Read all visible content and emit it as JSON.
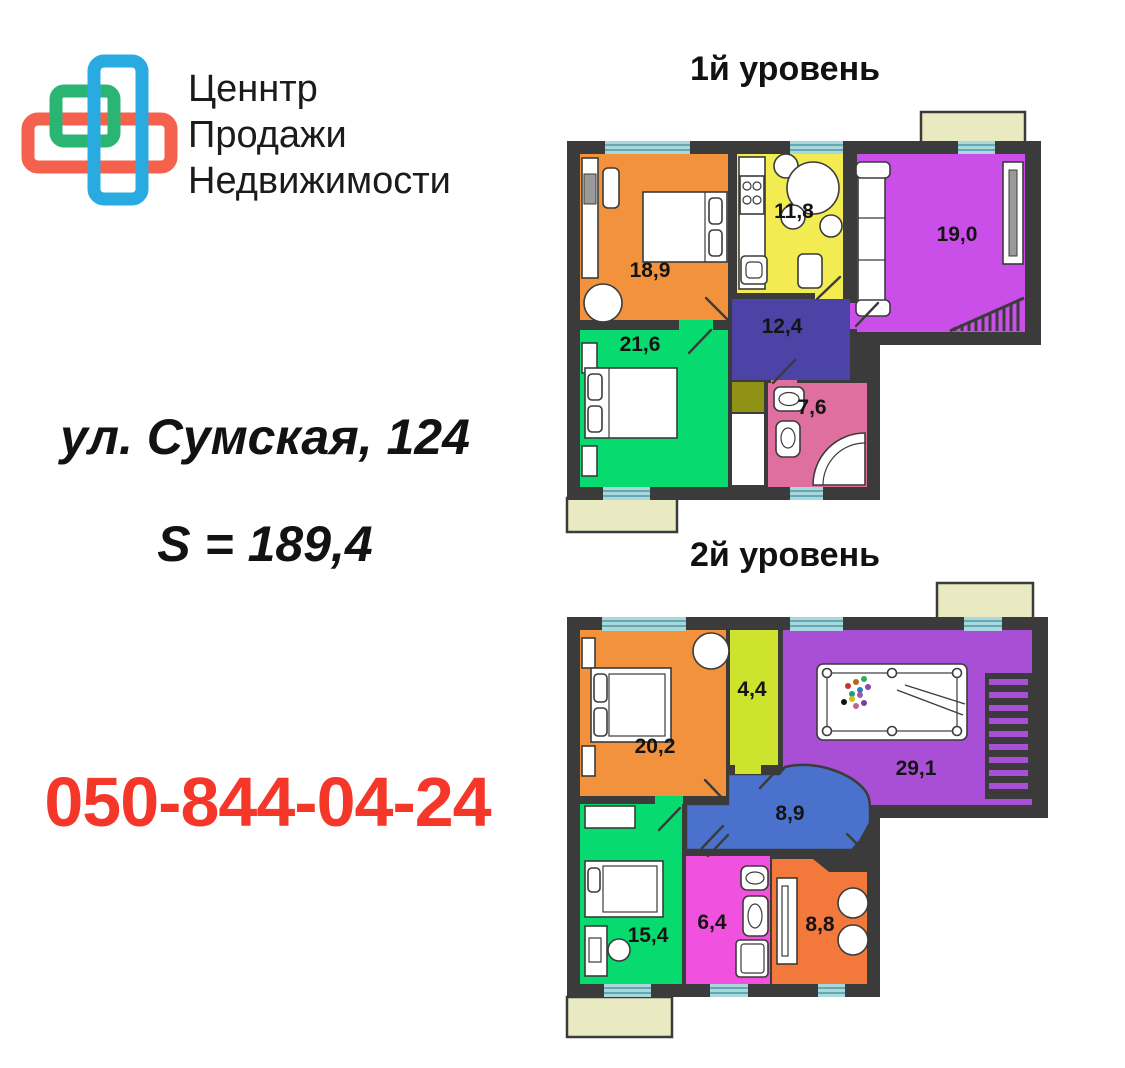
{
  "logo": {
    "line1": "Ценнтр",
    "line2": "Продажи",
    "line3": "Недвижимости",
    "colors": {
      "blue": "#29ABE2",
      "green": "#2BB573",
      "red": "#F4624E"
    }
  },
  "listing": {
    "address": "ул. Сумская, 124",
    "total_area": "S = 189,4",
    "phone": "050-844-04-24",
    "phone_color": "#F5372A"
  },
  "palette": {
    "wall": "#3B3B3B",
    "window_glass": "#A9D7DB",
    "window_line": "#63A9B4",
    "balcony": "#E9EAC1"
  },
  "floor1": {
    "title": "1й уровень",
    "rooms": [
      {
        "id": "bedroom-1",
        "area": "18,9",
        "color": "#F2923C"
      },
      {
        "id": "kitchen",
        "area": "11,8",
        "color": "#F2EC52"
      },
      {
        "id": "living-room",
        "area": "19,0",
        "color": "#C94FE8"
      },
      {
        "id": "bedroom-2",
        "area": "21,6",
        "color": "#07DB70"
      },
      {
        "id": "hallway",
        "area": "12,4",
        "color": "#4C43A6"
      },
      {
        "id": "bathroom",
        "area": "7,6",
        "color": "#DE6F9F"
      },
      {
        "id": "storage",
        "color": "#8F9214"
      }
    ]
  },
  "floor2": {
    "title": "2й уровень",
    "rooms": [
      {
        "id": "bedroom-1",
        "area": "20,2",
        "color": "#F2923C"
      },
      {
        "id": "dressing",
        "area": "4,4",
        "color": "#CDE32E"
      },
      {
        "id": "billiard-room",
        "area": "29,1",
        "color": "#A94FD6"
      },
      {
        "id": "hallway",
        "area": "8,9",
        "color": "#4A72CC"
      },
      {
        "id": "bedroom-2",
        "area": "15,4",
        "color": "#07DB70"
      },
      {
        "id": "bathroom",
        "area": "6,4",
        "color": "#F051DE"
      },
      {
        "id": "study",
        "area": "8,8",
        "color": "#F2793B"
      }
    ]
  }
}
